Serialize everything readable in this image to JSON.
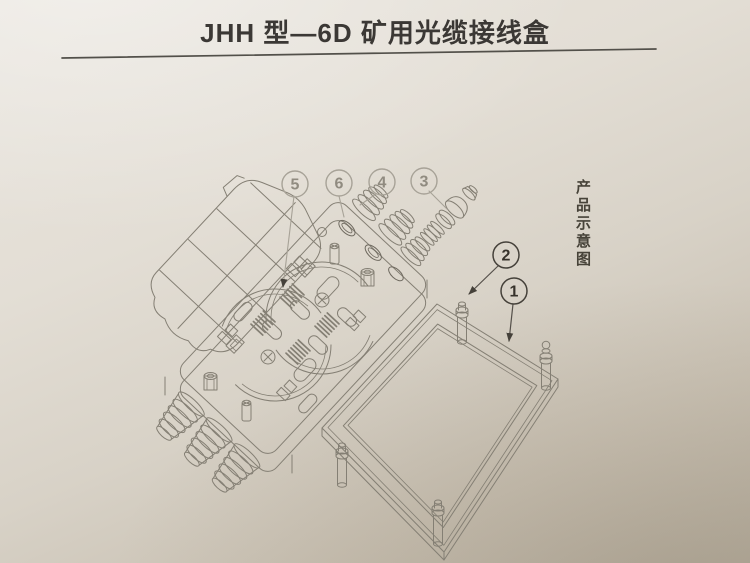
{
  "title": {
    "text": "JHH 型—6D 矿用光缆接线盒"
  },
  "side_caption": {
    "text": "产品示意图"
  },
  "callouts": {
    "c1": "1",
    "c2": "2",
    "c3": "3",
    "c4": "4",
    "c5": "5",
    "c6": "6"
  },
  "colors": {
    "paper_light": "#e9e5de",
    "paper_dark": "#b9b1a2",
    "line": "#847f74",
    "line_dark": "#45413a",
    "callout_light": "#a7a297",
    "ink": "#3b3835"
  }
}
